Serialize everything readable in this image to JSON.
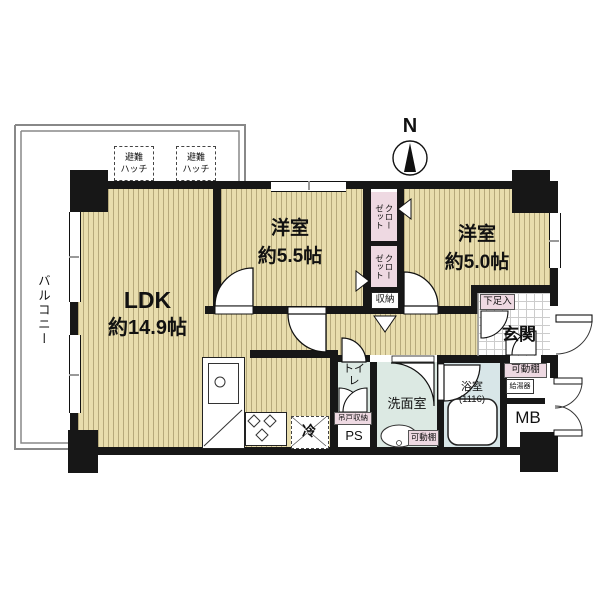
{
  "compass": {
    "label": "N"
  },
  "balcony": {
    "label": "バルコニー"
  },
  "hatch": {
    "line1": "避難",
    "line2": "ハッチ"
  },
  "rooms": {
    "ldk": {
      "name": "LDK",
      "area": "約14.9帖"
    },
    "bedroom55": {
      "name": "洋室",
      "area": "約5.5帖"
    },
    "bedroom50": {
      "name": "洋室",
      "area": "約5.0帖"
    },
    "entrance": {
      "name": "玄関"
    },
    "washroom": {
      "name": "洗面室"
    },
    "toilet": {
      "name": "トイレ"
    },
    "bathroom": {
      "name": "浴室",
      "size": "(1116)"
    }
  },
  "storage": {
    "closet_col1": "クロー",
    "closet_col2": "ゼット",
    "shuunou": "収納",
    "shoe_cabinet": "下足入",
    "movable_shelf": "可動棚",
    "hanging_storage": "吊戸収納"
  },
  "utilities": {
    "pipe_space": "PS",
    "meter_box": "MB",
    "water_heater": "給湯器",
    "refrigerator": "冷"
  },
  "colors": {
    "wall": "#171717",
    "wood_floor": "#e8ddad",
    "closet_pink": "#eed9e2",
    "sanitary_floor": "#dce9e3",
    "bath_floor": "#d8e6e8"
  }
}
